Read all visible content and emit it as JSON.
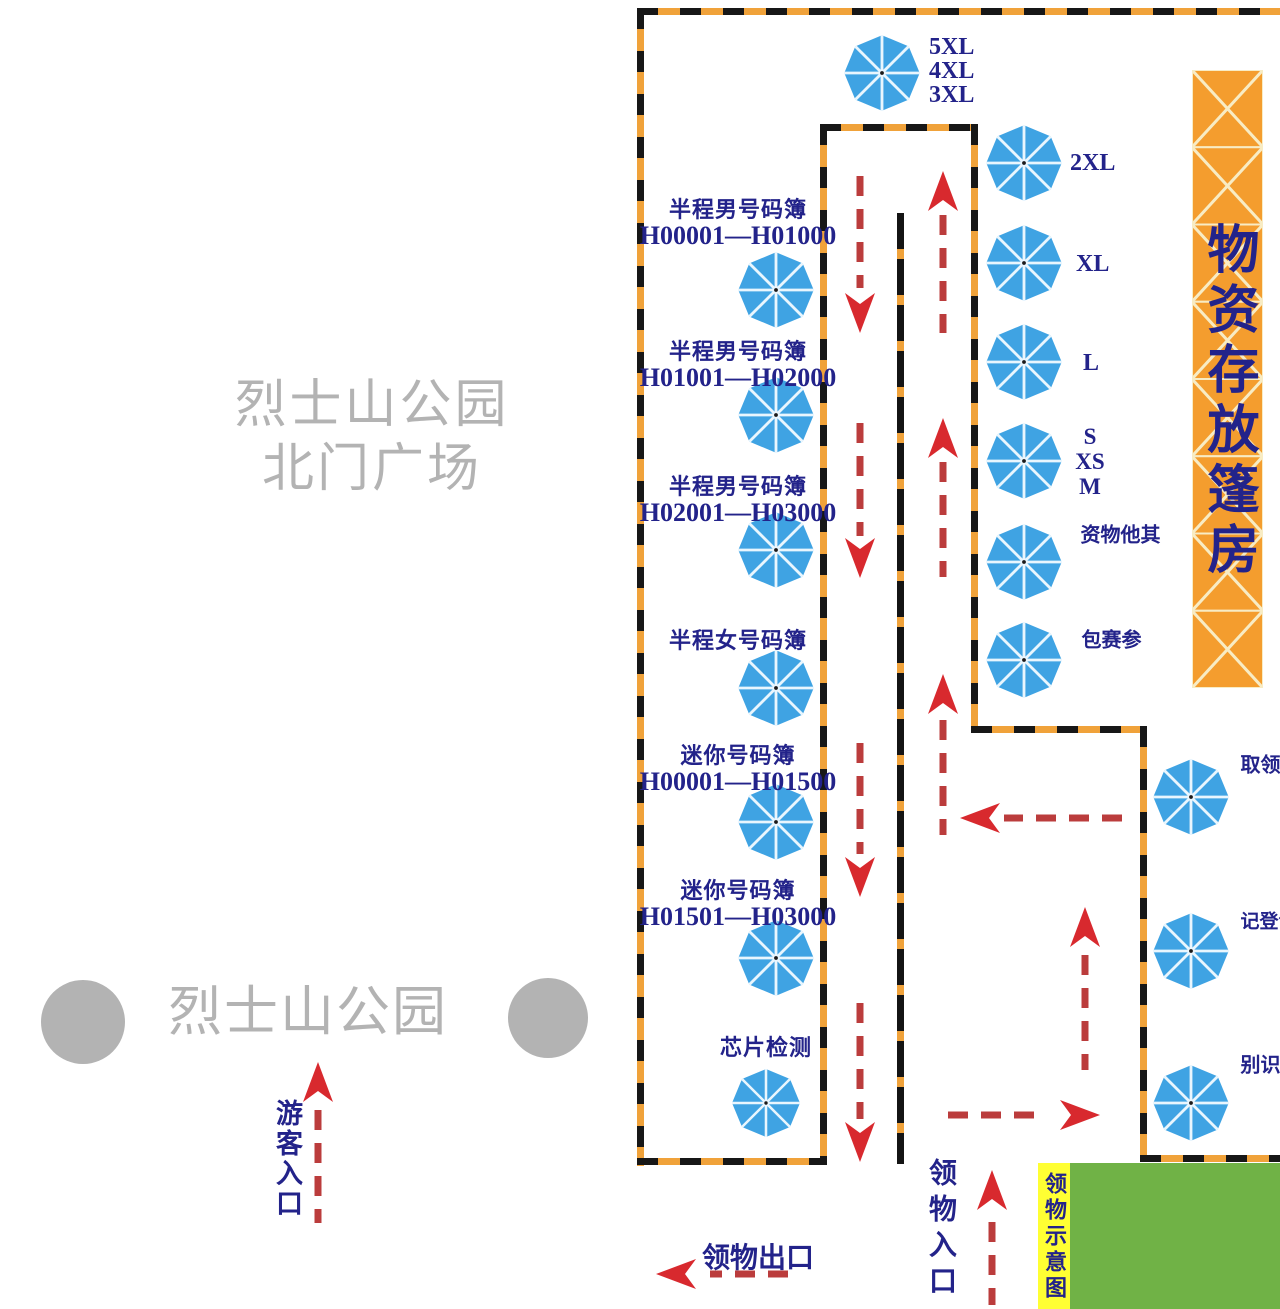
{
  "park": {
    "north_gate_line1": "烈士山公园",
    "north_gate_line2": "北门广场",
    "park_name": "烈士山公园",
    "visitor_entrance": "游客入口"
  },
  "storage_banner": {
    "text": "物资存放篷房"
  },
  "flow_signs": {
    "pickup_exit": "领物出口",
    "pickup_entrance": "领物入口",
    "pickup_diagram_title": "领物示意图"
  },
  "umbrellas": [
    {
      "id": "sizes-5xl-3xl",
      "label_lines": [
        "5XL",
        "4XL",
        "3XL"
      ]
    },
    {
      "id": "size-2xl",
      "label_lines": [
        "2XL"
      ]
    },
    {
      "id": "size-xl",
      "label_lines": [
        "XL"
      ]
    },
    {
      "id": "size-l",
      "label_lines": [
        "L"
      ]
    },
    {
      "id": "sizes-s-xs-m",
      "label_lines": [
        "S",
        "XS",
        "M"
      ]
    },
    {
      "id": "other-supplies",
      "label_vertical": "其他物资"
    },
    {
      "id": "race-pack",
      "label_vertical": "参赛包"
    },
    {
      "id": "half-men-1",
      "label_top": "半程男号码簿",
      "label_range": "H00001—H01000"
    },
    {
      "id": "half-men-2",
      "label_top": "半程男号码簿",
      "label_range": "H01001—H02000"
    },
    {
      "id": "half-men-3",
      "label_top": "半程男号码簿",
      "label_range": "H02001—H03000"
    },
    {
      "id": "half-women",
      "label_top": "半程女号码簿"
    },
    {
      "id": "mini-1",
      "label_top": "迷你号码簿",
      "label_range": "H00001—H01500"
    },
    {
      "id": "mini-2",
      "label_top": "迷你号码簿",
      "label_range": "H01501—H03000"
    },
    {
      "id": "chip-check",
      "label_top": "芯片检测"
    },
    {
      "id": "team-pickup",
      "label_vertical": "团队领取"
    },
    {
      "id": "proxy-register",
      "label_vertical": "代领登记"
    },
    {
      "id": "id-check",
      "label_vertical": "身份识别"
    }
  ],
  "colors": {
    "umbrella_blue": "#3fa3e3",
    "umbrella_spoke": "#e9f6fe",
    "boundary_orange": "#f0a23a",
    "arrow_head_red": "#d8292e",
    "arrow_dash_red": "#bb3c3c",
    "label_navy": "#23238a",
    "banner_orange": "#f49d2e",
    "banner_line": "#f8ecc4",
    "park_gray": "#b3b3b3",
    "lawn_green": "#70b246",
    "sign_yellow": "#ffff33"
  }
}
